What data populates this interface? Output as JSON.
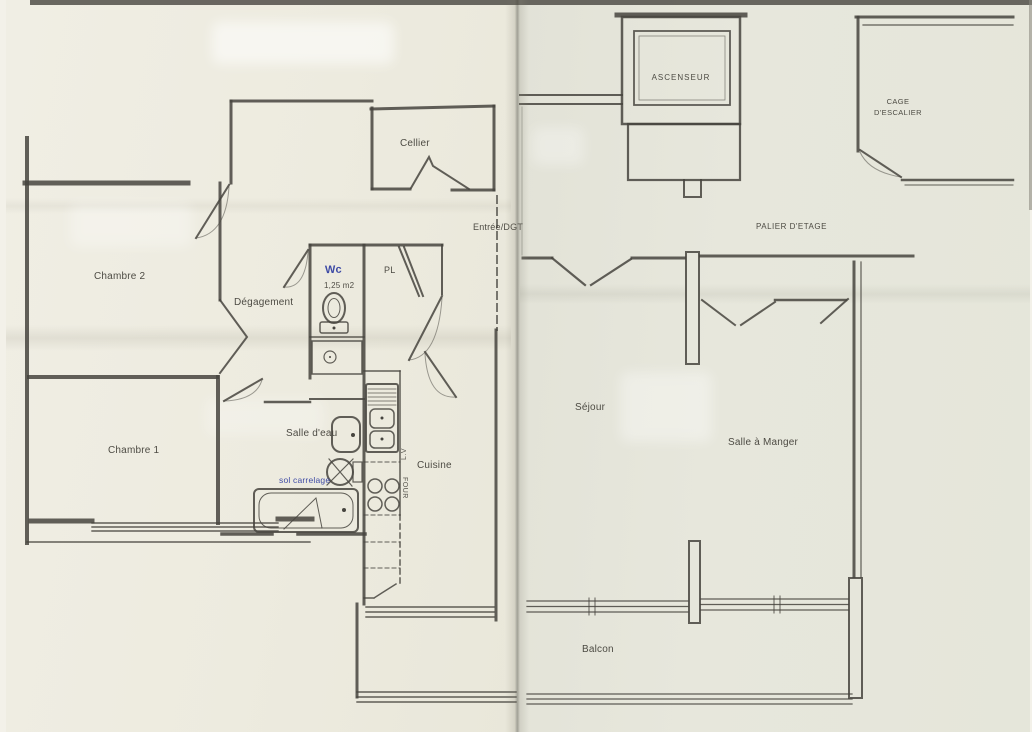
{
  "colors": {
    "paper_left": "#eeebe0",
    "paper_right": "#e6e6db",
    "ink": "#46443e",
    "blue_ink": "#2f3da1"
  },
  "left_page": {
    "labels": {
      "cellier": "Cellier",
      "entree": "Entrée/DGT",
      "chambre2": "Chambre 2",
      "degagement": "Dégagement",
      "wc": "Wc",
      "wc_area": "1,25 m2",
      "placard": "PL",
      "chambre1": "Chambre 1",
      "salle_deau": "Salle d'eau",
      "sol_note": "sol carrelage",
      "cuisine": "Cuisine",
      "lave_vaisselle": "L.V",
      "four": "FOUR"
    }
  },
  "right_page": {
    "labels": {
      "ascenseur": "ASCENSEUR",
      "cage_escalier_line1": "CAGE",
      "cage_escalier_line2": "D'ESCALIER",
      "palier": "PALIER D'ETAGE",
      "sejour": "Séjour",
      "salle_a_manger": "Salle à Manger",
      "balcon": "Balcon"
    }
  }
}
